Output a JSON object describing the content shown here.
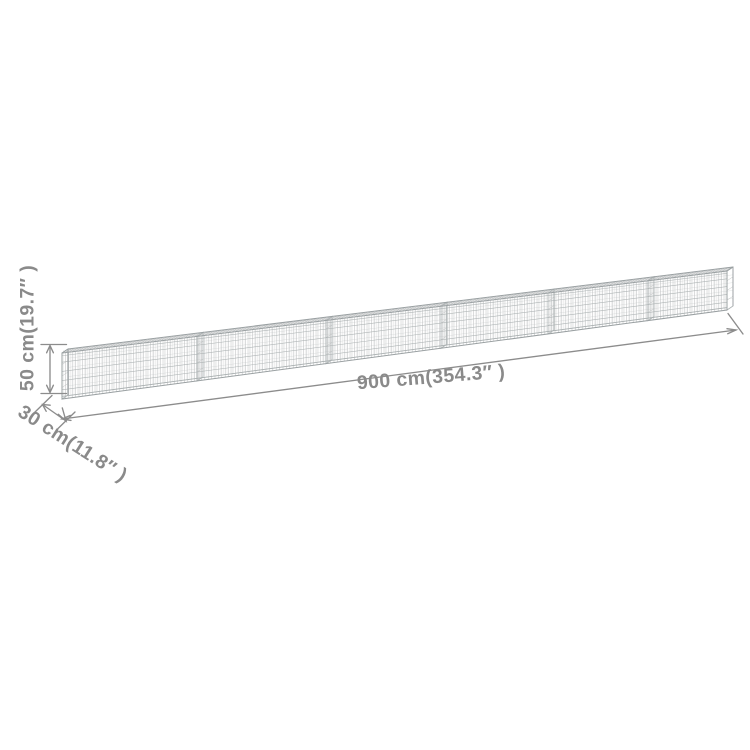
{
  "product_diagram": {
    "object": "gabion-wall-with-dimensions",
    "segments": 6,
    "dimensions": {
      "length_label": "900 cm(354.3″ )",
      "height_label": "50 cm(19.7″ )",
      "depth_label": "30 cm(11.8″ )"
    },
    "colors": {
      "background": "#ffffff",
      "dimension": "#8c8c8c",
      "label_text": "#8a8a8a",
      "mesh_light": "#b7babb",
      "mesh_mid": "#aab0b1",
      "outline": "#9aa0a2"
    }
  }
}
